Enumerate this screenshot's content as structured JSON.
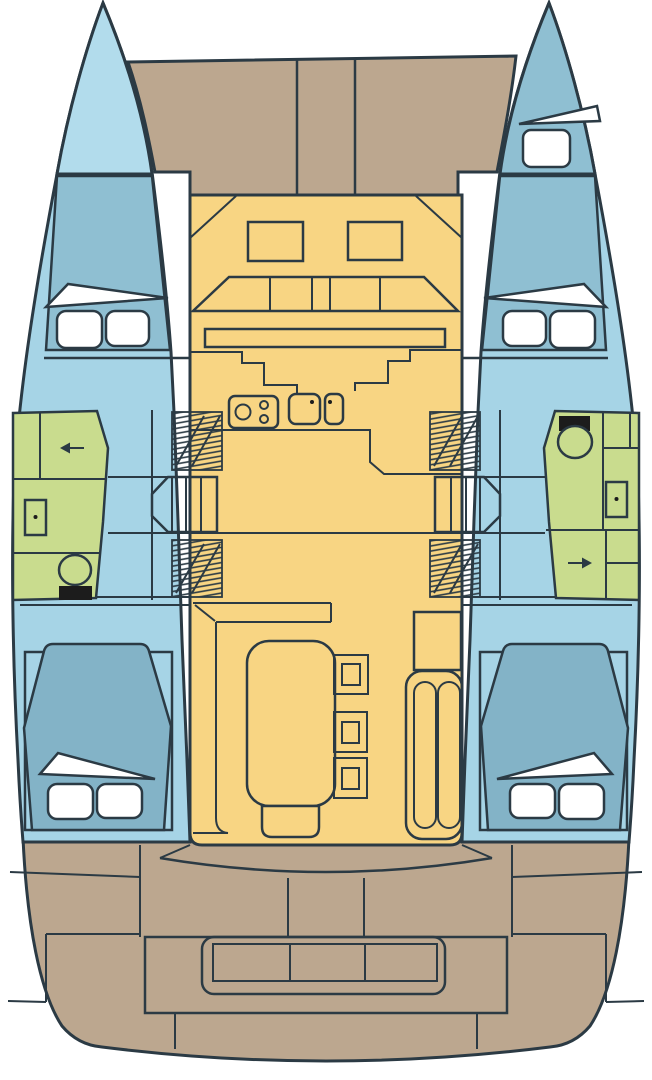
{
  "diagram": {
    "type": "boat-deck-plan",
    "subject": "sailing-catamaran-interior-layout",
    "orientation": "bow-up",
    "hulls": 2,
    "cabins": 4,
    "heads": 2
  },
  "colors": {
    "background": "#ffffff",
    "ink": "#2b3a44",
    "hull": "#a6d4e6",
    "bow": "#b2dcec",
    "cabin": "#8fbfd2",
    "berth": "#83b3c7",
    "salon": "#f8d583",
    "deck": "#bca78f",
    "head": "#c9dc8e",
    "white": "#ffffff",
    "black": "#1c1c1c"
  },
  "rooms": [
    {
      "id": "foredeck",
      "type": "deck",
      "features": [
        "anchor-locker-strip"
      ]
    },
    {
      "id": "starboard-forepeak-berth",
      "type": "berth",
      "features": [
        "single-berth",
        "hatch"
      ]
    },
    {
      "id": "port-forward-cabin",
      "type": "cabin",
      "features": [
        "double-berth",
        "two-pillows"
      ]
    },
    {
      "id": "starboard-forward-cabin",
      "type": "cabin",
      "features": [
        "double-berth",
        "two-pillows"
      ]
    },
    {
      "id": "port-head",
      "type": "bathroom",
      "features": [
        "toilet",
        "washbasin",
        "shower",
        "door-arrow-left"
      ]
    },
    {
      "id": "starboard-head",
      "type": "bathroom",
      "features": [
        "toilet",
        "washbasin",
        "shower",
        "door-arrow-right"
      ]
    },
    {
      "id": "port-companionway",
      "type": "stairs",
      "features": [
        "forward-steps",
        "aft-steps",
        "mid-step-box"
      ]
    },
    {
      "id": "starboard-companionway",
      "type": "stairs",
      "features": [
        "forward-steps",
        "aft-steps",
        "mid-step-box"
      ]
    },
    {
      "id": "galley",
      "type": "galley",
      "features": [
        "three-burner-stove",
        "double-sink",
        "l-shaped-counter"
      ]
    },
    {
      "id": "salon",
      "type": "salon",
      "features": [
        "forward-settee",
        "settee-table",
        "l-shaped-sofa",
        "dining-table",
        "three-stools",
        "chaise-bench",
        "cabinet"
      ]
    },
    {
      "id": "port-aft-cabin",
      "type": "cabin",
      "features": [
        "double-berth",
        "two-pillows"
      ]
    },
    {
      "id": "starboard-aft-cabin",
      "type": "cabin",
      "features": [
        "double-berth",
        "two-pillows"
      ]
    },
    {
      "id": "cockpit",
      "type": "deck",
      "features": [
        "curved-bench",
        "three-section-table",
        "stern-bench",
        "swim-platform"
      ]
    }
  ]
}
